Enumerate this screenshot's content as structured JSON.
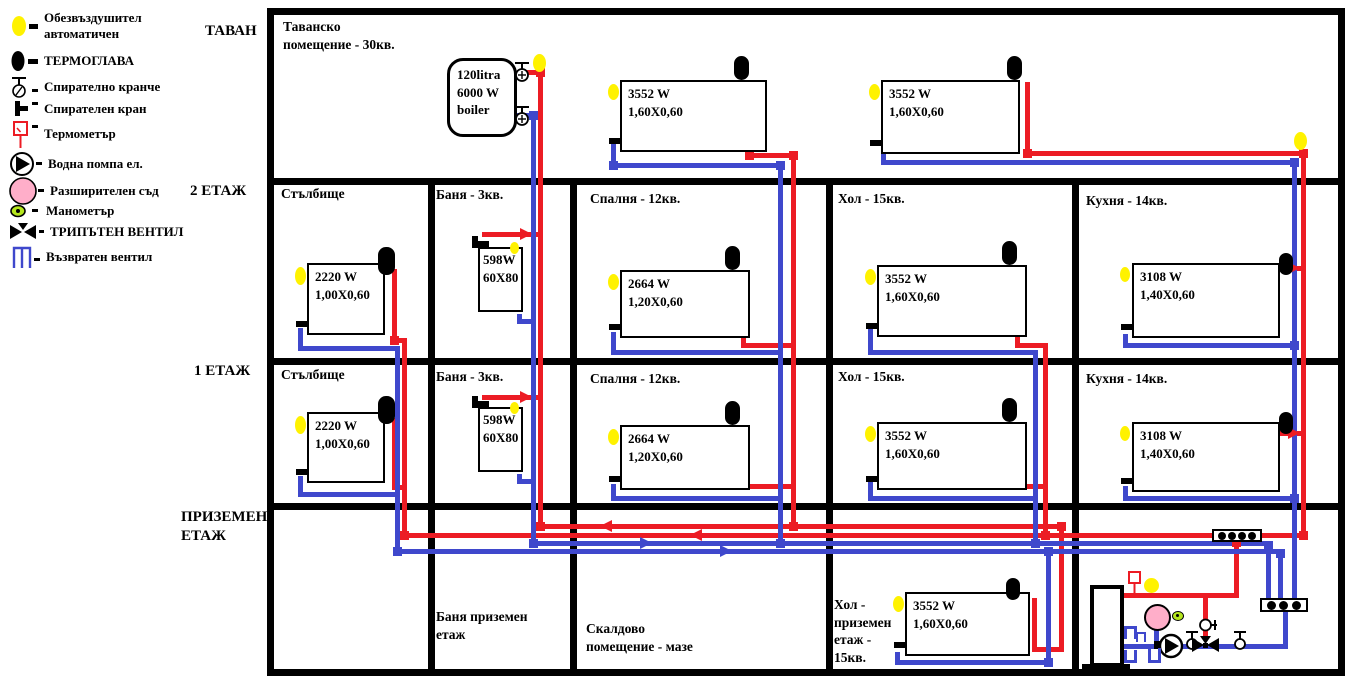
{
  "colors": {
    "supply": "#ec1c24",
    "return": "#3f48cc",
    "air_vent": "#fff200",
    "expansion_vessel": "#ffaec9",
    "manometer": "#b5e61d",
    "wall": "#000000"
  },
  "legend": {
    "items": [
      {
        "icon": "air-vent-icon",
        "label": "Обезвъздушител\nавтоматичен"
      },
      {
        "icon": "thermo-head-icon",
        "label": "ТЕРМОГЛАВА"
      },
      {
        "icon": "shutoff-tap-icon",
        "label": "Спирателно кранче"
      },
      {
        "icon": "shutoff-valve-icon",
        "label": "Спирателен кран"
      },
      {
        "icon": "thermometer-icon",
        "label": "Термометър"
      },
      {
        "icon": "water-pump-icon",
        "label": "Водна помпа ел."
      },
      {
        "icon": "expansion-vessel-icon",
        "label": "Разширителен съд"
      },
      {
        "icon": "manometer-icon",
        "label": "Манометър"
      },
      {
        "icon": "three-way-valve-icon",
        "label": "ТРИПЪТЕН ВЕНТИЛ"
      },
      {
        "icon": "check-valve-icon",
        "label": "Възвратен вентил"
      }
    ]
  },
  "floor_labels": {
    "attic": "ТАВАН",
    "second": "2 ЕТАЖ",
    "first": "1 ЕТАЖ",
    "ground": "ПРИЗЕМЕН\nЕТАЖ"
  },
  "attic": {
    "room_label": "Таванско\nпомещение - 30кв.",
    "boiler_label": "120litra\n6000 W\nboiler"
  },
  "rooms": {
    "f2": [
      "Стълбище",
      "Баня - 3кв.",
      "Спалня - 12кв.",
      "Хол - 15кв.",
      "Кухня - 14кв."
    ],
    "f1": [
      "Стълбище",
      "Баня - 3кв.",
      "Спалня - 12кв.",
      "Хол - 15кв.",
      "Кухня - 14кв."
    ],
    "ground": [
      "Баня приземен\nетаж",
      "Скалдово\nпомещение - мазе",
      "Хол -\nприземен\nетаж -\n15кв."
    ]
  },
  "radiators": [
    {
      "id": "attic-1",
      "power": "3552 W",
      "size": "1,60X0,60"
    },
    {
      "id": "attic-2",
      "power": "3552 W",
      "size": "1,60X0,60"
    },
    {
      "id": "f2-stair",
      "power": "2220 W",
      "size": "1,00X0,60"
    },
    {
      "id": "f2-bath",
      "power": "598W",
      "size": "60X80"
    },
    {
      "id": "f2-bed",
      "power": "2664 W",
      "size": "1,20X0,60"
    },
    {
      "id": "f2-hall",
      "power": "3552 W",
      "size": "1,60X0,60"
    },
    {
      "id": "f2-kitchen",
      "power": "3108 W",
      "size": "1,40X0,60"
    },
    {
      "id": "f1-stair",
      "power": "2220 W",
      "size": "1,00X0,60"
    },
    {
      "id": "f1-bath",
      "power": "598W",
      "size": "60X80"
    },
    {
      "id": "f1-bed",
      "power": "2664 W",
      "size": "1,20X0,60"
    },
    {
      "id": "f1-hall",
      "power": "3552 W",
      "size": "1,60X0,60"
    },
    {
      "id": "f1-kitchen",
      "power": "3108 W",
      "size": "1,40X0,60"
    },
    {
      "id": "g-hall",
      "power": "3552 W",
      "size": "1,60X0,60"
    }
  ]
}
